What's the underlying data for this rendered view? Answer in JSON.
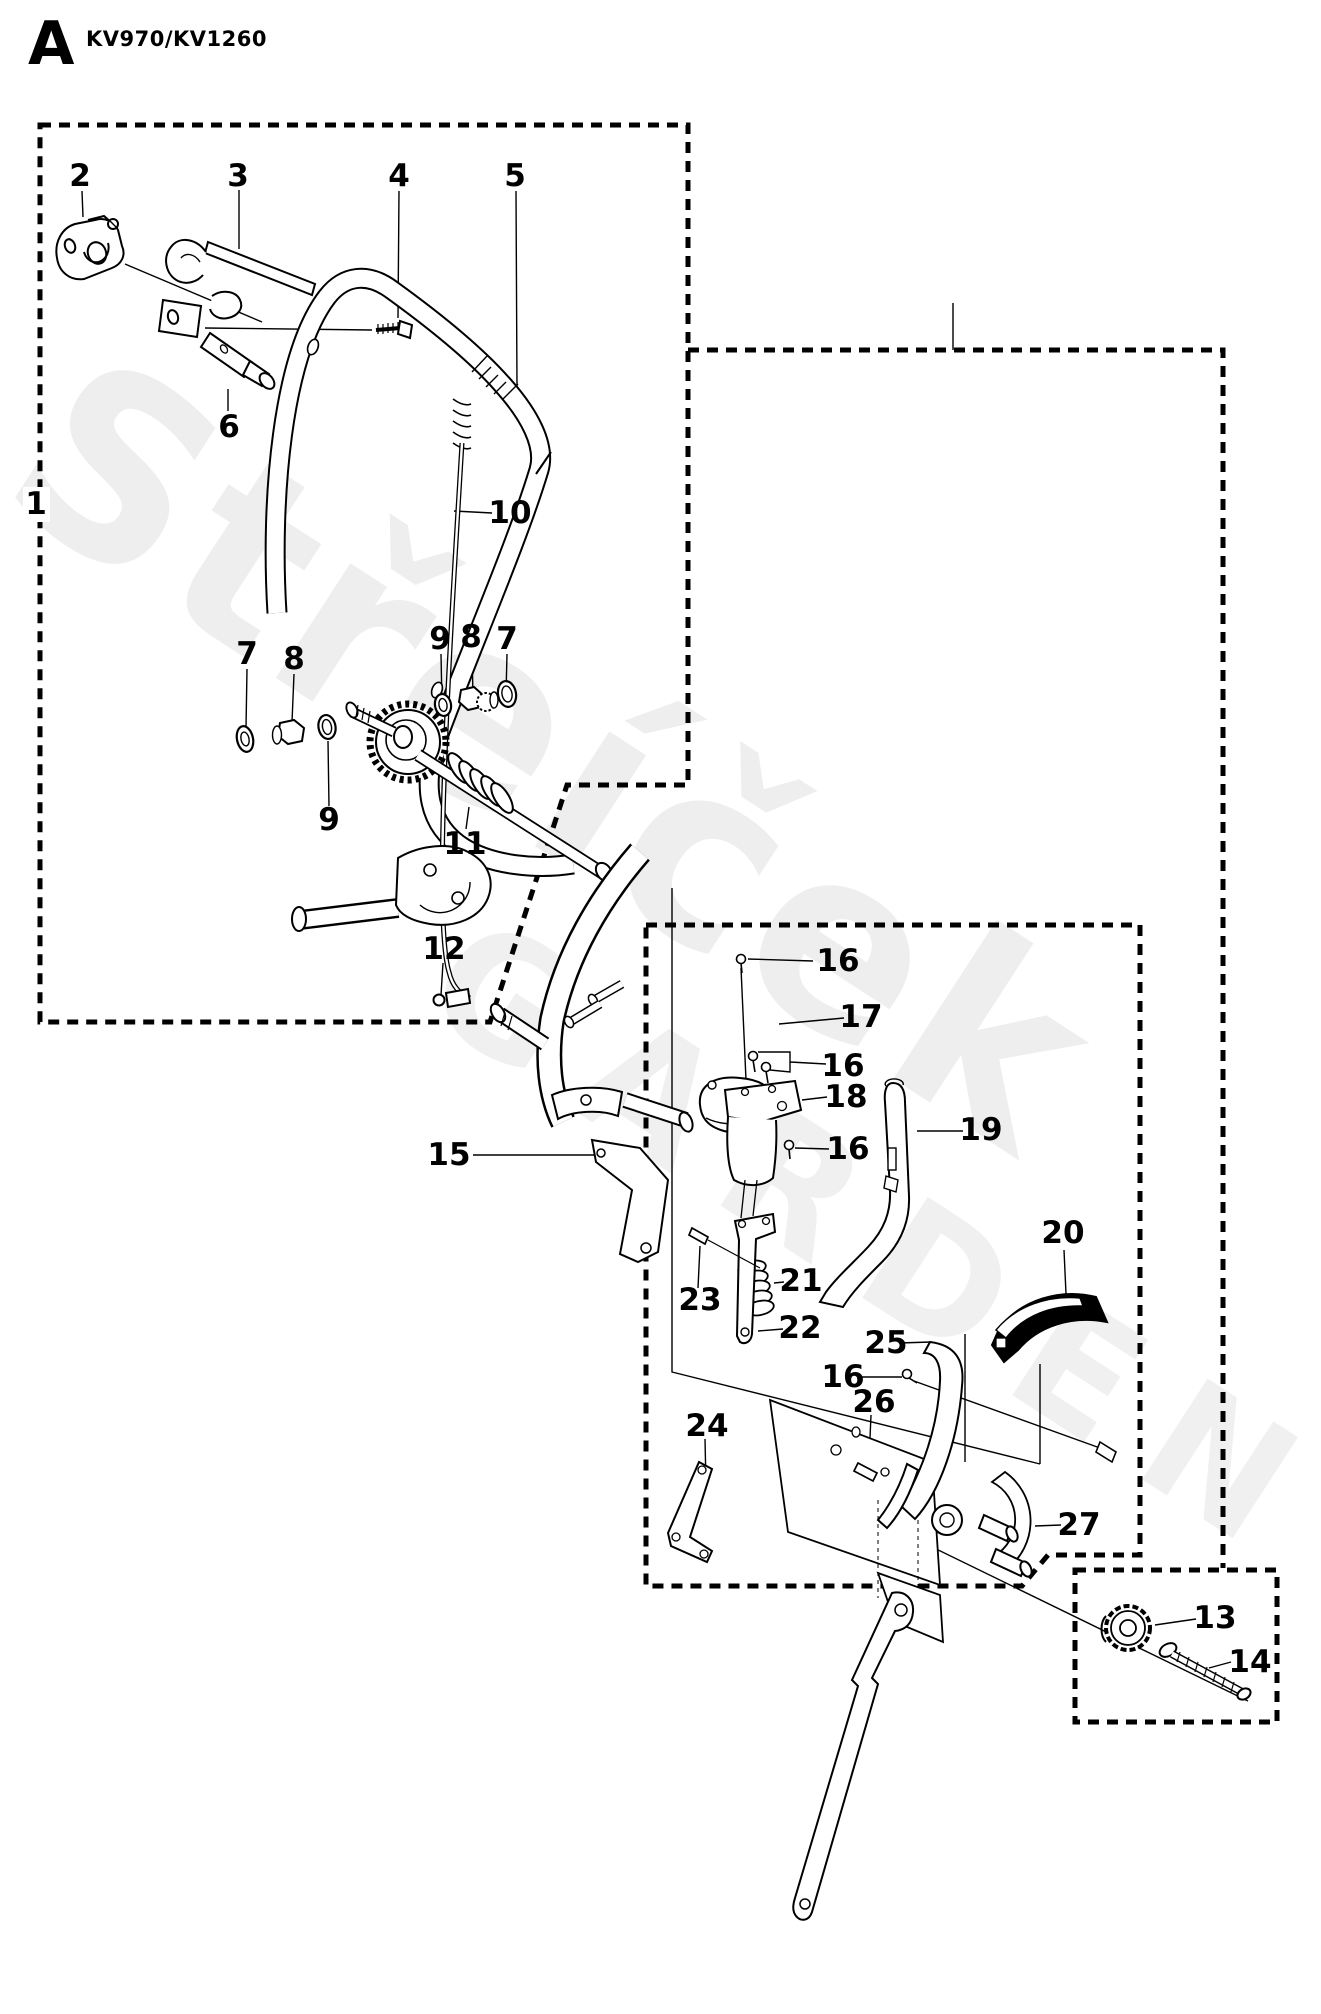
{
  "header": {
    "section_letter": "A",
    "model": "KV970/KV1260"
  },
  "watermark": {
    "line1": "Střeíček",
    "line2": "GARDEN"
  },
  "callouts": [
    {
      "n": "1",
      "x": 36,
      "y": 504
    },
    {
      "n": "2",
      "x": 80,
      "y": 176
    },
    {
      "n": "3",
      "x": 238,
      "y": 176
    },
    {
      "n": "4",
      "x": 399,
      "y": 176
    },
    {
      "n": "5",
      "x": 515,
      "y": 176
    },
    {
      "n": "6",
      "x": 229,
      "y": 427
    },
    {
      "n": "7",
      "x": 247,
      "y": 654
    },
    {
      "n": "8",
      "x": 294,
      "y": 659
    },
    {
      "n": "9",
      "x": 329,
      "y": 820
    },
    {
      "n": "9",
      "x": 440,
      "y": 639
    },
    {
      "n": "8",
      "x": 471,
      "y": 637
    },
    {
      "n": "7",
      "x": 507,
      "y": 639
    },
    {
      "n": "10",
      "x": 510,
      "y": 513
    },
    {
      "n": "11",
      "x": 465,
      "y": 844
    },
    {
      "n": "12",
      "x": 444,
      "y": 949
    },
    {
      "n": "15",
      "x": 449,
      "y": 1155
    },
    {
      "n": "16",
      "x": 838,
      "y": 961
    },
    {
      "n": "17",
      "x": 861,
      "y": 1017
    },
    {
      "n": "16",
      "x": 843,
      "y": 1066
    },
    {
      "n": "18",
      "x": 846,
      "y": 1097
    },
    {
      "n": "16",
      "x": 848,
      "y": 1149
    },
    {
      "n": "19",
      "x": 981,
      "y": 1130
    },
    {
      "n": "20",
      "x": 1063,
      "y": 1233
    },
    {
      "n": "21",
      "x": 801,
      "y": 1281
    },
    {
      "n": "22",
      "x": 800,
      "y": 1328
    },
    {
      "n": "23",
      "x": 700,
      "y": 1300
    },
    {
      "n": "24",
      "x": 707,
      "y": 1426
    },
    {
      "n": "25",
      "x": 886,
      "y": 1343
    },
    {
      "n": "16",
      "x": 843,
      "y": 1377
    },
    {
      "n": "26",
      "x": 874,
      "y": 1402
    },
    {
      "n": "27",
      "x": 1079,
      "y": 1525
    },
    {
      "n": "13",
      "x": 1215,
      "y": 1618
    },
    {
      "n": "14",
      "x": 1250,
      "y": 1662
    }
  ]
}
